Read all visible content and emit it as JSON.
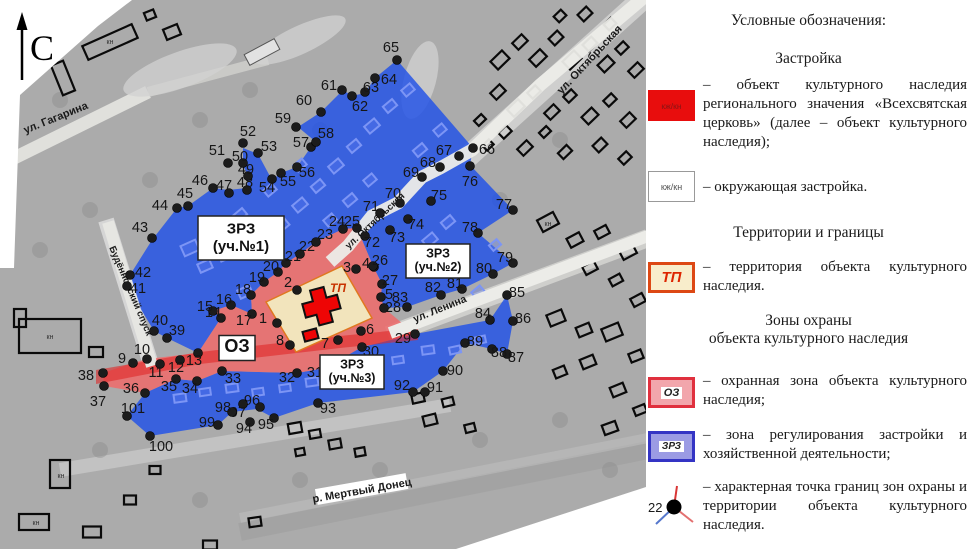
{
  "legend": {
    "title": "Условные обозначения:",
    "sections": [
      {
        "heading": "Застройка",
        "items": [
          {
            "swatch_label": "кж/кн",
            "text": "– объект культурного наследия регионального значения «Всехсвятская церковь» (далее – объект культурного наследия);"
          },
          {
            "swatch_label": "кж/кн",
            "text": "– окружающая застройка."
          }
        ]
      },
      {
        "heading": "Территории и границы",
        "items": [
          {
            "swatch_label": "ТП",
            "text": "– территория объекта культурного наследия."
          }
        ]
      },
      {
        "heading": "Зоны охраны\nобъекта культурного наследия",
        "items": [
          {
            "swatch_label": "ОЗ",
            "text": "– охранная зона объекта культурного наследия;"
          },
          {
            "swatch_label": "ЗРЗ",
            "text": "– зона регулирования застройки и хозяйственной деятельности;"
          },
          {
            "swatch_label": "22",
            "text": "– характерная точка границ зон охраны и территории объекта культурного наследия."
          }
        ]
      }
    ],
    "point_symbol": {
      "label": "22"
    }
  },
  "map": {
    "north_label": "С",
    "tp_label": "ТП",
    "zone_boxes": [
      {
        "lines": [
          "ЗРЗ",
          "(уч.№1)"
        ],
        "x": 241,
        "y": 238,
        "w": 86,
        "h": 44,
        "fs": 15
      },
      {
        "lines": [
          "ЗРЗ",
          "(уч.№2)"
        ],
        "x": 438,
        "y": 261,
        "w": 64,
        "h": 34,
        "fs": 12.5
      },
      {
        "lines": [
          "ЗРЗ",
          "(уч.№3)"
        ],
        "x": 352,
        "y": 372,
        "w": 64,
        "h": 34,
        "fs": 12.5
      },
      {
        "lines": [
          "ОЗ"
        ],
        "x": 237,
        "y": 348,
        "w": 36,
        "h": 25,
        "fs": 18
      }
    ],
    "streets": [
      {
        "name": "ул. Гагарина",
        "x": 57,
        "y": 121,
        "angle": -22,
        "fs": 11
      },
      {
        "name": "ул. Октябрьская",
        "x": 592,
        "y": 62,
        "angle": -47,
        "fs": 11
      },
      {
        "name": "ул. Октябрьская",
        "x": 377,
        "y": 223,
        "angle": -43,
        "fs": 9.5
      },
      {
        "name": "ул. Ленина",
        "x": 441,
        "y": 312,
        "angle": -22,
        "fs": 10.5
      },
      {
        "name": "Будённовский спуск",
        "x": 128,
        "y": 292,
        "angle": 67,
        "fs": 9.5
      }
    ],
    "river": {
      "name": "р. Мертвый Донец",
      "x": 362,
      "y": 491,
      "angle": -10,
      "fs": 11
    },
    "building_labels": [
      {
        "text": "кн",
        "x": 50,
        "y": 339
      },
      {
        "text": "кн",
        "x": 61,
        "y": 478
      },
      {
        "text": "кн",
        "x": 36,
        "y": 525
      },
      {
        "text": "кн",
        "x": 548,
        "y": 226
      },
      {
        "text": "кн",
        "x": 110,
        "y": 44
      }
    ],
    "points": [
      [
        1,
        277,
        323,
        263,
        318
      ],
      [
        2,
        297,
        290,
        288,
        282
      ],
      [
        3,
        356,
        269,
        347,
        267
      ],
      [
        4,
        374,
        267,
        366,
        263
      ],
      [
        5,
        381,
        297,
        389,
        294
      ],
      [
        6,
        361,
        331,
        370,
        329
      ],
      [
        7,
        338,
        340,
        325,
        343
      ],
      [
        8,
        290,
        345,
        280,
        340
      ],
      [
        9,
        133,
        363,
        122,
        358
      ],
      [
        10,
        147,
        359,
        142,
        349
      ],
      [
        11,
        160,
        364,
        156,
        372
      ],
      [
        12,
        180,
        360,
        176,
        367
      ],
      [
        13,
        198,
        353,
        194,
        360
      ],
      [
        14,
        221,
        318,
        213,
        312
      ],
      [
        15,
        213,
        311,
        205,
        306
      ],
      [
        16,
        231,
        305,
        224,
        299
      ],
      [
        17,
        252,
        314,
        244,
        320
      ],
      [
        18,
        251,
        295,
        243,
        289
      ],
      [
        19,
        264,
        282,
        257,
        277
      ],
      [
        20,
        278,
        272,
        271,
        266
      ],
      [
        21,
        286,
        263,
        293,
        256
      ],
      [
        22,
        300,
        254,
        307,
        246
      ],
      [
        23,
        316,
        242,
        325,
        234
      ],
      [
        24,
        343,
        229,
        337,
        221
      ],
      [
        25,
        357,
        228,
        352,
        221
      ],
      [
        26,
        373,
        266,
        380,
        260
      ],
      [
        27,
        382,
        284,
        390,
        280
      ],
      [
        28,
        384,
        308,
        393,
        307
      ],
      [
        29,
        415,
        334,
        403,
        338
      ],
      [
        30,
        362,
        347,
        371,
        351
      ],
      [
        31,
        325,
        368,
        315,
        372
      ],
      [
        32,
        297,
        373,
        287,
        377
      ],
      [
        33,
        222,
        371,
        233,
        378
      ],
      [
        34,
        197,
        381,
        190,
        388
      ],
      [
        35,
        176,
        379,
        169,
        386
      ],
      [
        36,
        145,
        393,
        131,
        388
      ],
      [
        37,
        104,
        386,
        98,
        401
      ],
      [
        38,
        103,
        373,
        86,
        375
      ],
      [
        39,
        167,
        338,
        177,
        330
      ],
      [
        40,
        154,
        331,
        160,
        320
      ],
      [
        41,
        127,
        286,
        138,
        288
      ],
      [
        42,
        130,
        275,
        143,
        272
      ],
      [
        43,
        152,
        238,
        140,
        227
      ],
      [
        44,
        177,
        208,
        160,
        205
      ],
      [
        45,
        188,
        206,
        185,
        193
      ],
      [
        46,
        213,
        188,
        200,
        180
      ],
      [
        47,
        229,
        193,
        224,
        185
      ],
      [
        48,
        247,
        190,
        245,
        182
      ],
      [
        49,
        248,
        176,
        246,
        169
      ],
      [
        50,
        243,
        163,
        240,
        156
      ],
      [
        51,
        228,
        163,
        217,
        150
      ],
      [
        52,
        243,
        143,
        248,
        131
      ],
      [
        53,
        258,
        153,
        269,
        146
      ],
      [
        54,
        272,
        179,
        267,
        187
      ],
      [
        55,
        281,
        173,
        288,
        181
      ],
      [
        56,
        297,
        167,
        307,
        172
      ],
      [
        57,
        311,
        147,
        301,
        142
      ],
      [
        58,
        316,
        142,
        326,
        133
      ],
      [
        59,
        296,
        127,
        283,
        118
      ],
      [
        60,
        321,
        112,
        304,
        100
      ],
      [
        61,
        342,
        90,
        329,
        85
      ],
      [
        62,
        352,
        96,
        360,
        106
      ],
      [
        63,
        365,
        92,
        371,
        87
      ],
      [
        64,
        375,
        78,
        389,
        79
      ],
      [
        65,
        397,
        60,
        391,
        47
      ],
      [
        66,
        473,
        148,
        487,
        149
      ],
      [
        67,
        459,
        156,
        444,
        150
      ],
      [
        68,
        440,
        167,
        428,
        162
      ],
      [
        69,
        422,
        177,
        411,
        172
      ],
      [
        70,
        400,
        203,
        393,
        193
      ],
      [
        71,
        380,
        213,
        371,
        206
      ],
      [
        72,
        365,
        236,
        372,
        242
      ],
      [
        73,
        390,
        230,
        397,
        237
      ],
      [
        74,
        408,
        219,
        416,
        224
      ],
      [
        75,
        431,
        201,
        439,
        195
      ],
      [
        76,
        470,
        166,
        470,
        181
      ],
      [
        77,
        513,
        210,
        504,
        204
      ],
      [
        78,
        478,
        233,
        470,
        227
      ],
      [
        79,
        513,
        263,
        505,
        257
      ],
      [
        80,
        493,
        274,
        484,
        268
      ],
      [
        81,
        462,
        289,
        455,
        283
      ],
      [
        82,
        441,
        295,
        433,
        287
      ],
      [
        83,
        407,
        307,
        400,
        297
      ],
      [
        84,
        490,
        320,
        483,
        313
      ],
      [
        85,
        507,
        295,
        517,
        292
      ],
      [
        86,
        513,
        321,
        523,
        318
      ],
      [
        87,
        507,
        354,
        516,
        357
      ],
      [
        88,
        492,
        349,
        499,
        352
      ],
      [
        89,
        465,
        343,
        475,
        341
      ],
      [
        90,
        443,
        371,
        455,
        370
      ],
      [
        91,
        425,
        392,
        435,
        387
      ],
      [
        92,
        413,
        392,
        402,
        385
      ],
      [
        93,
        318,
        403,
        328,
        408
      ],
      [
        94,
        250,
        422,
        244,
        428
      ],
      [
        95,
        274,
        418,
        266,
        424
      ],
      [
        96,
        260,
        407,
        252,
        400
      ],
      [
        97,
        243,
        404,
        238,
        412
      ],
      [
        98,
        232,
        412,
        223,
        407
      ],
      [
        99,
        218,
        425,
        207,
        422
      ],
      [
        100,
        150,
        436,
        161,
        446
      ],
      [
        101,
        127,
        416,
        133,
        408
      ]
    ],
    "colors": {
      "zrz_fill": "#2050e8",
      "oz_fill": "#ee6a6a",
      "oz_road": "#e02828",
      "territory_fill": "#f2e4bc",
      "territory_stroke": "#e07820",
      "church_fill": "#ee0505",
      "point_fill": "#1c1c1c"
    }
  }
}
